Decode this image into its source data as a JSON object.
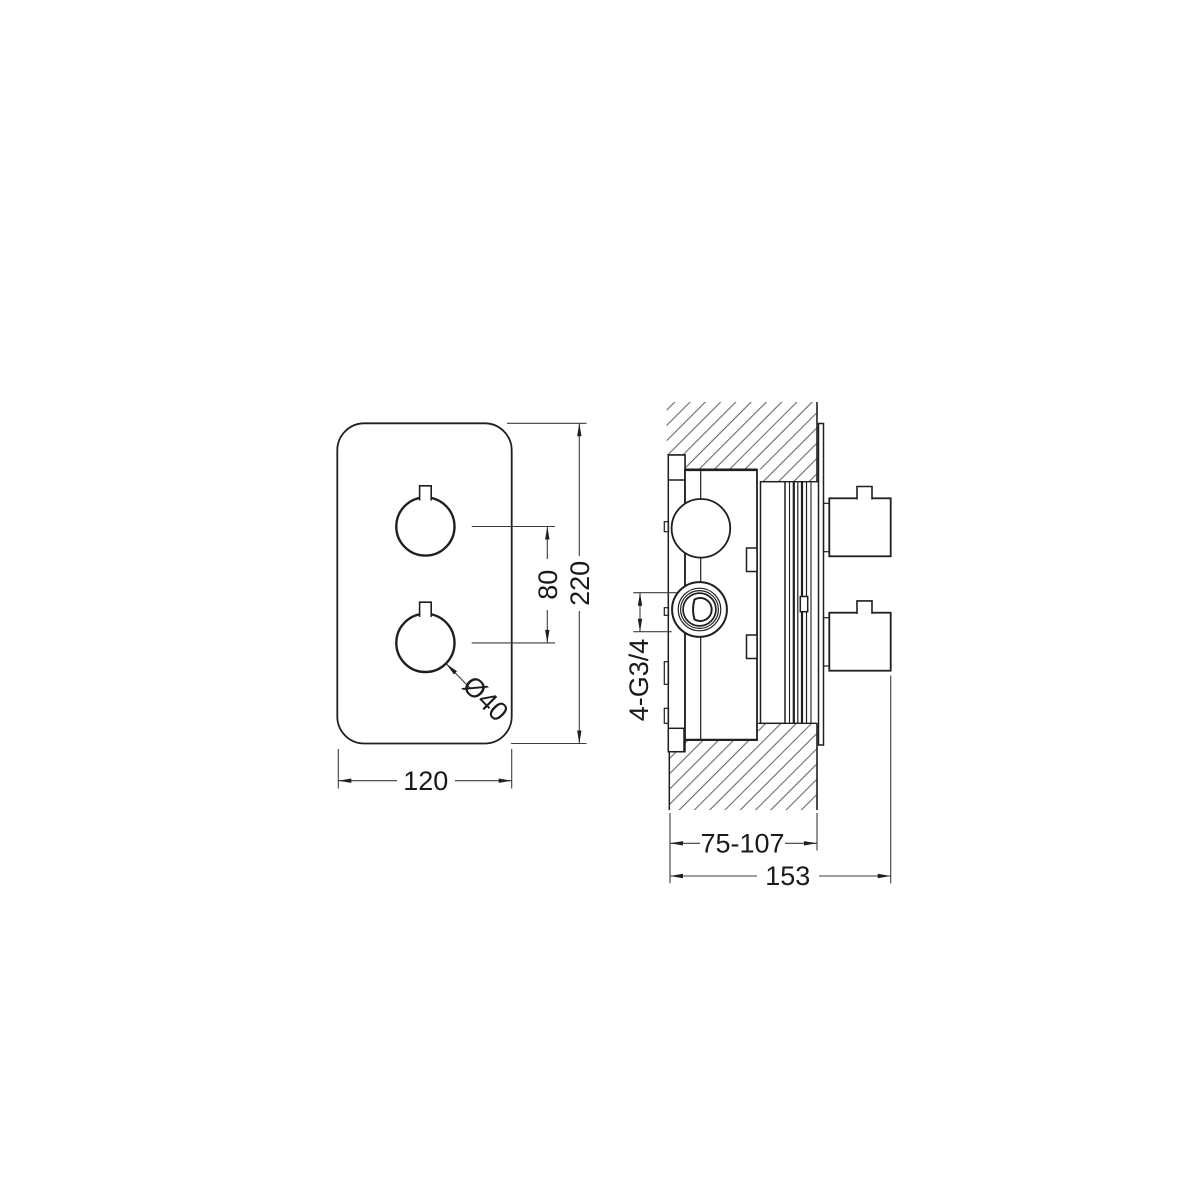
{
  "drawing": {
    "type": "technical-dimension-drawing",
    "subject": "concealed thermostatic shower valve",
    "units": "mm",
    "front_view": {
      "plate_width": "120",
      "plate_height": "220",
      "handle_spacing": "80",
      "handle_diameter": "Ø40"
    },
    "side_view": {
      "connection_thread": "4-G3/4",
      "recess_depth_range": "75-107",
      "total_depth": "153"
    }
  }
}
